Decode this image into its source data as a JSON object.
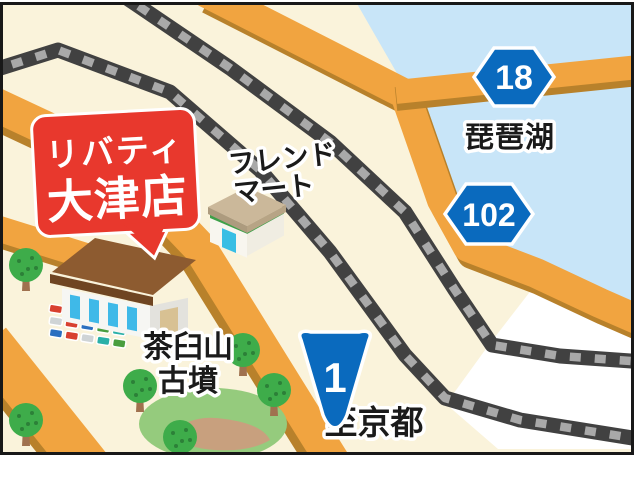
{
  "map": {
    "balloon": {
      "line1": "リバティ",
      "line2": "大津店"
    },
    "labels": {
      "friend_mart_line1": "フレンド",
      "friend_mart_line2": "マート",
      "lake": "琵琶湖",
      "kofun_line1": "茶臼山",
      "kofun_line2": "古墳",
      "to_kyoto": "至京都"
    },
    "route_badges": [
      {
        "number": "18",
        "shape": "hexagon"
      },
      {
        "number": "102",
        "shape": "hexagon"
      },
      {
        "number": "1",
        "shape": "shield"
      }
    ],
    "colors": {
      "land": "#faf3db",
      "water": "#c8e5f8",
      "road": "#f1a440",
      "road_shadow": "#b8812b",
      "rail_dark": "#414141",
      "rail_dash": "#a9a9a9",
      "badge_blue": "#0a6abe",
      "balloon_red": "#e8382d",
      "tree_green": "#3eac4a",
      "kofun_green": "#95cb7d"
    }
  }
}
